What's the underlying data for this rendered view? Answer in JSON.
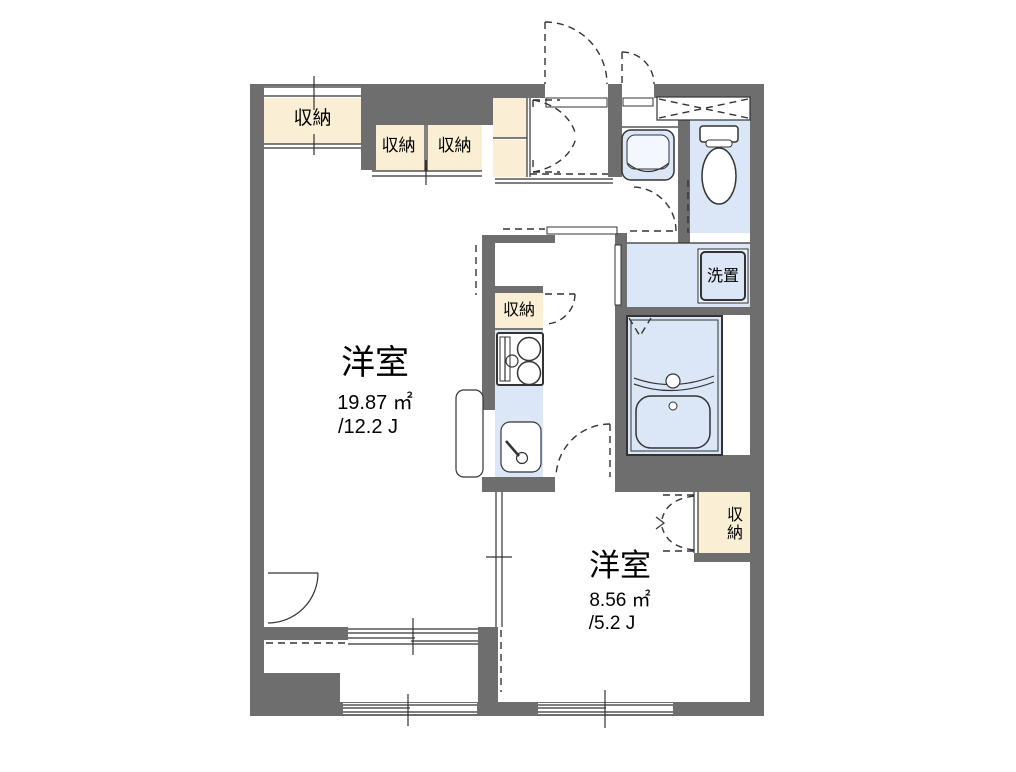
{
  "plan": {
    "type": "floor-plan",
    "background": "#ffffff",
    "colors": {
      "wall": "#6e6e6e",
      "closet": "#faefd5",
      "water": "#dbe7f6",
      "line": "#333333",
      "bg": "#ffffff"
    },
    "labels": {
      "closet": "収納",
      "washer": "洗置"
    },
    "rooms": [
      {
        "name": "洋室",
        "area": "19.87 ㎡",
        "tatami": "/12.2 J"
      },
      {
        "name": "洋室",
        "area": "8.56 ㎡",
        "tatami": "/5.2 J"
      }
    ]
  }
}
